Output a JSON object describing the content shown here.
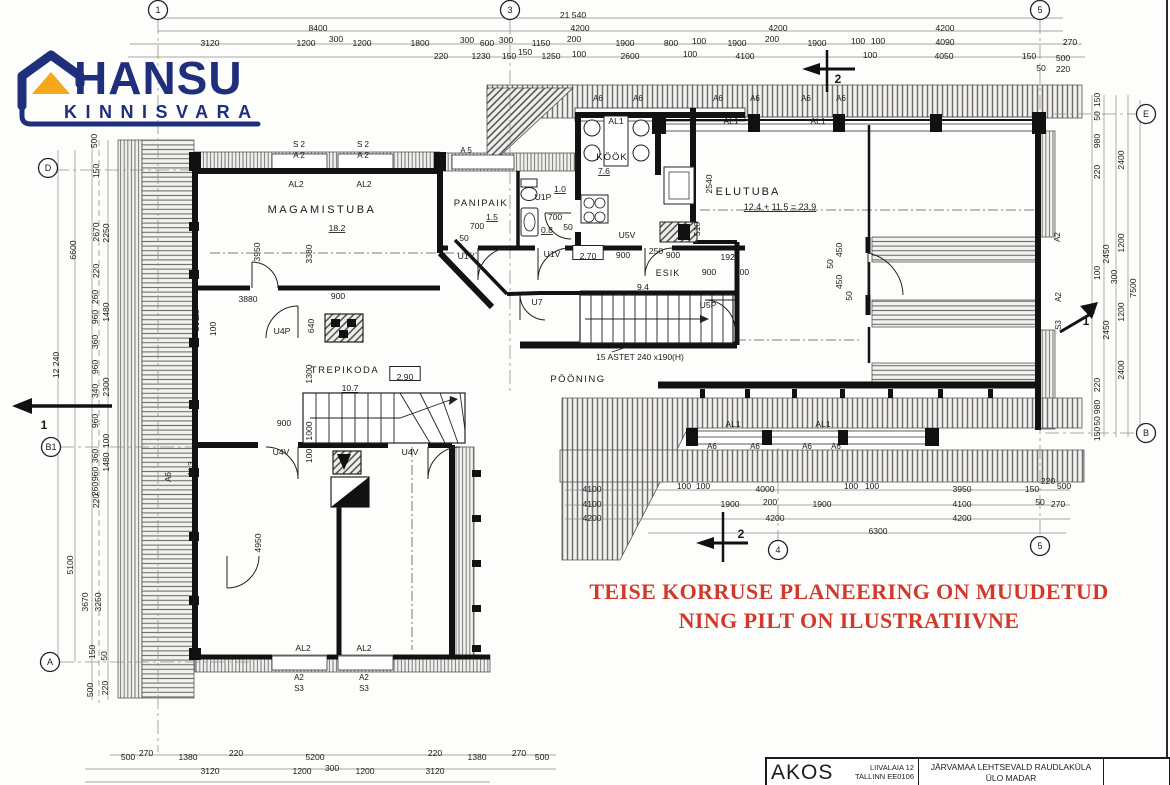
{
  "logo": {
    "name": "HANSU",
    "subname": "KINNISVARA",
    "brand_color": "#1f2f7c",
    "roof_color": "#f5a81c"
  },
  "disclaimer": {
    "line1": "TEISE KORRUSE PLANEERING ON  MUUDETUD",
    "line2": "NING PILT ON ILUSTRATIIVNE",
    "color": "#d0392b"
  },
  "title_block": {
    "company": "AKOS",
    "address_line1": "LIIVALAIA 12",
    "address_line2": "TALLINN EE0106",
    "project_line1": "JÄRVAMAA LEHTSEVALD RAUDLAKÜLA",
    "project_line2": "ÜLO MADAR"
  },
  "plan": {
    "overall_width_mm": "21 540",
    "overall_height_mm": "12 240",
    "bubbles": [
      {
        "t": "1",
        "x": 158,
        "y": 10
      },
      {
        "t": "3",
        "x": 510,
        "y": 10
      },
      {
        "t": "5",
        "x": 1040,
        "y": 10
      },
      {
        "t": "D",
        "x": 48,
        "y": 168
      },
      {
        "t": "B1",
        "x": 51,
        "y": 447
      },
      {
        "t": "A",
        "x": 50,
        "y": 662
      },
      {
        "t": "E",
        "x": 1146,
        "y": 114
      },
      {
        "t": "B",
        "x": 1146,
        "y": 433
      },
      {
        "t": "4",
        "x": 778,
        "y": 550
      },
      {
        "t": "5",
        "x": 1040,
        "y": 546
      }
    ],
    "labels": [
      {
        "t": "21 540",
        "x": 573,
        "y": 15
      },
      {
        "t": "8400",
        "x": 318,
        "y": 28
      },
      {
        "t": "4200",
        "x": 580,
        "y": 28
      },
      {
        "t": "4200",
        "x": 778,
        "y": 28
      },
      {
        "t": "4200",
        "x": 945,
        "y": 28
      },
      {
        "t": "3120",
        "x": 210,
        "y": 43
      },
      {
        "t": "1200",
        "x": 306,
        "y": 43
      },
      {
        "t": "300",
        "x": 336,
        "y": 39
      },
      {
        "t": "1200",
        "x": 362,
        "y": 43
      },
      {
        "t": "1800",
        "x": 420,
        "y": 43
      },
      {
        "t": "300",
        "x": 467,
        "y": 40
      },
      {
        "t": "600",
        "x": 487,
        "y": 43
      },
      {
        "t": "300",
        "x": 506,
        "y": 40
      },
      {
        "t": "1150",
        "x": 541,
        "y": 43
      },
      {
        "t": "200",
        "x": 574,
        "y": 39
      },
      {
        "t": "1900",
        "x": 625,
        "y": 43
      },
      {
        "t": "800",
        "x": 671,
        "y": 43
      },
      {
        "t": "100",
        "x": 699,
        "y": 41
      },
      {
        "t": "1900",
        "x": 737,
        "y": 43
      },
      {
        "t": "200",
        "x": 772,
        "y": 39
      },
      {
        "t": "1900",
        "x": 817,
        "y": 43
      },
      {
        "t": "100",
        "x": 858,
        "y": 41
      },
      {
        "t": "100",
        "x": 878,
        "y": 41
      },
      {
        "t": "4090",
        "x": 945,
        "y": 42
      },
      {
        "t": "270",
        "x": 1070,
        "y": 42
      },
      {
        "t": "220",
        "x": 441,
        "y": 56
      },
      {
        "t": "1230",
        "x": 481,
        "y": 56
      },
      {
        "t": "150",
        "x": 509,
        "y": 56
      },
      {
        "t": "150",
        "x": 525,
        "y": 52
      },
      {
        "t": "1250",
        "x": 551,
        "y": 56
      },
      {
        "t": "100",
        "x": 579,
        "y": 54
      },
      {
        "t": "2600",
        "x": 630,
        "y": 56
      },
      {
        "t": "100",
        "x": 690,
        "y": 54
      },
      {
        "t": "4100",
        "x": 745,
        "y": 56
      },
      {
        "t": "100",
        "x": 870,
        "y": 55
      },
      {
        "t": "4050",
        "x": 944,
        "y": 56
      },
      {
        "t": "150",
        "x": 1029,
        "y": 56
      },
      {
        "t": "500",
        "x": 1063,
        "y": 58
      },
      {
        "t": "50",
        "x": 1041,
        "y": 68
      },
      {
        "t": "220",
        "x": 1063,
        "y": 69
      },
      {
        "t": "500",
        "x": 94,
        "y": 141,
        "r": 1
      },
      {
        "t": "150",
        "x": 96,
        "y": 171,
        "r": 1
      },
      {
        "t": "2670",
        "x": 96,
        "y": 232,
        "r": 1
      },
      {
        "t": "2250",
        "x": 106,
        "y": 233,
        "r": 1
      },
      {
        "t": "6600",
        "x": 73,
        "y": 250,
        "r": 1
      },
      {
        "t": "220",
        "x": 96,
        "y": 271,
        "r": 1
      },
      {
        "t": "260",
        "x": 95,
        "y": 297,
        "r": 1
      },
      {
        "t": "960",
        "x": 95,
        "y": 317,
        "r": 1
      },
      {
        "t": "1480",
        "x": 106,
        "y": 312,
        "r": 1
      },
      {
        "t": "360",
        "x": 95,
        "y": 342,
        "r": 1
      },
      {
        "t": "12 240",
        "x": 56,
        "y": 365,
        "r": 1
      },
      {
        "t": "960",
        "x": 95,
        "y": 367,
        "r": 1
      },
      {
        "t": "340",
        "x": 95,
        "y": 391,
        "r": 1
      },
      {
        "t": "2300",
        "x": 106,
        "y": 387,
        "r": 1
      },
      {
        "t": "960",
        "x": 95,
        "y": 421,
        "r": 1
      },
      {
        "t": "100",
        "x": 106,
        "y": 441,
        "r": 1
      },
      {
        "t": "360",
        "x": 95,
        "y": 456,
        "r": 1
      },
      {
        "t": "1480",
        "x": 106,
        "y": 462,
        "r": 1
      },
      {
        "t": "960",
        "x": 95,
        "y": 474,
        "r": 1
      },
      {
        "t": "260",
        "x": 95,
        "y": 489,
        "r": 1
      },
      {
        "t": "220",
        "x": 96,
        "y": 501,
        "r": 1
      },
      {
        "t": "5100",
        "x": 70,
        "y": 565,
        "r": 1
      },
      {
        "t": "3670",
        "x": 85,
        "y": 602,
        "r": 1
      },
      {
        "t": "3250",
        "x": 98,
        "y": 602,
        "r": 1
      },
      {
        "t": "150",
        "x": 92,
        "y": 652,
        "r": 1
      },
      {
        "t": "50",
        "x": 104,
        "y": 656,
        "r": 1
      },
      {
        "t": "500",
        "x": 90,
        "y": 690,
        "r": 1
      },
      {
        "t": "220",
        "x": 105,
        "y": 688,
        "r": 1
      },
      {
        "t": "150",
        "x": 1097,
        "y": 100,
        "r": 1
      },
      {
        "t": "50",
        "x": 1097,
        "y": 116,
        "r": 1
      },
      {
        "t": "980",
        "x": 1097,
        "y": 141,
        "r": 1
      },
      {
        "t": "2400",
        "x": 1121,
        "y": 160,
        "r": 1
      },
      {
        "t": "220",
        "x": 1097,
        "y": 172,
        "r": 1
      },
      {
        "t": "2450",
        "x": 1106,
        "y": 254,
        "r": 1
      },
      {
        "t": "1200",
        "x": 1121,
        "y": 243,
        "r": 1
      },
      {
        "t": "100",
        "x": 1097,
        "y": 273,
        "r": 1
      },
      {
        "t": "300",
        "x": 1114,
        "y": 277,
        "r": 1
      },
      {
        "t": "7500",
        "x": 1133,
        "y": 288,
        "r": 1
      },
      {
        "t": "1200",
        "x": 1121,
        "y": 312,
        "r": 1
      },
      {
        "t": "2450",
        "x": 1106,
        "y": 330,
        "r": 1
      },
      {
        "t": "2400",
        "x": 1121,
        "y": 370,
        "r": 1
      },
      {
        "t": "220",
        "x": 1097,
        "y": 385,
        "r": 1
      },
      {
        "t": "980",
        "x": 1097,
        "y": 407,
        "r": 1
      },
      {
        "t": "50",
        "x": 1097,
        "y": 421,
        "r": 1
      },
      {
        "t": "150",
        "x": 1097,
        "y": 434,
        "r": 1
      },
      {
        "t": "500",
        "x": 128,
        "y": 757
      },
      {
        "t": "270",
        "x": 146,
        "y": 753
      },
      {
        "t": "1380",
        "x": 188,
        "y": 757
      },
      {
        "t": "220",
        "x": 236,
        "y": 753
      },
      {
        "t": "5200",
        "x": 315,
        "y": 757
      },
      {
        "t": "220",
        "x": 435,
        "y": 753
      },
      {
        "t": "1380",
        "x": 477,
        "y": 757
      },
      {
        "t": "270",
        "x": 519,
        "y": 753
      },
      {
        "t": "500",
        "x": 542,
        "y": 757
      },
      {
        "t": "3120",
        "x": 210,
        "y": 771
      },
      {
        "t": "1200",
        "x": 302,
        "y": 771
      },
      {
        "t": "300",
        "x": 332,
        "y": 768
      },
      {
        "t": "1200",
        "x": 365,
        "y": 771
      },
      {
        "t": "3120",
        "x": 435,
        "y": 771
      },
      {
        "t": "4100",
        "x": 592,
        "y": 489
      },
      {
        "t": "100",
        "x": 684,
        "y": 486
      },
      {
        "t": "100",
        "x": 703,
        "y": 486
      },
      {
        "t": "4000",
        "x": 765,
        "y": 489
      },
      {
        "t": "100",
        "x": 851,
        "y": 486
      },
      {
        "t": "100",
        "x": 872,
        "y": 486
      },
      {
        "t": "3950",
        "x": 962,
        "y": 489
      },
      {
        "t": "150",
        "x": 1032,
        "y": 489
      },
      {
        "t": "220",
        "x": 1048,
        "y": 481
      },
      {
        "t": "500",
        "x": 1064,
        "y": 486
      },
      {
        "t": "4100",
        "x": 592,
        "y": 504
      },
      {
        "t": "1900",
        "x": 730,
        "y": 504
      },
      {
        "t": "200",
        "x": 770,
        "y": 502
      },
      {
        "t": "1900",
        "x": 822,
        "y": 504
      },
      {
        "t": "4100",
        "x": 962,
        "y": 504
      },
      {
        "t": "50",
        "x": 1040,
        "y": 502
      },
      {
        "t": "270",
        "x": 1058,
        "y": 504
      },
      {
        "t": "4200",
        "x": 592,
        "y": 518
      },
      {
        "t": "4200",
        "x": 775,
        "y": 518
      },
      {
        "t": "4200",
        "x": 962,
        "y": 518
      },
      {
        "t": "6300",
        "x": 878,
        "y": 531
      },
      {
        "t": "MAGAMISTUBA",
        "x": 322,
        "y": 210,
        "s": 11,
        "sp": 2.5,
        "n": "room-label-magamistuba"
      },
      {
        "t": "18.2",
        "x": 337,
        "y": 228,
        "u": 1,
        "n": "room-area"
      },
      {
        "t": "PANIPAIK",
        "x": 481,
        "y": 203,
        "s": 9.5,
        "sp": 1.5,
        "n": "room-label-panipaik"
      },
      {
        "t": "1.5",
        "x": 492,
        "y": 217,
        "u": 1,
        "n": "room-area"
      },
      {
        "t": "KÖÖK",
        "x": 612,
        "y": 157,
        "s": 9.5,
        "sp": 1,
        "n": "room-label-kook"
      },
      {
        "t": "7.6",
        "x": 604,
        "y": 171,
        "u": 1,
        "n": "room-area"
      },
      {
        "t": "ELUTUBA",
        "x": 748,
        "y": 192,
        "s": 11,
        "sp": 2,
        "n": "room-label-elutuba"
      },
      {
        "t": "12.4 + 11.5 = 23.9",
        "x": 780,
        "y": 207,
        "u": 1,
        "s": 9,
        "n": "room-area"
      },
      {
        "t": "TREPIKODA",
        "x": 345,
        "y": 370,
        "s": 9.5,
        "sp": 1.5,
        "n": "room-label-trepikoda"
      },
      {
        "t": "10.7",
        "x": 350,
        "y": 388,
        "u": 1,
        "n": "room-area"
      },
      {
        "t": "PÖÖNING",
        "x": 578,
        "y": 379,
        "s": 9.5,
        "sp": 1.5,
        "n": "room-label-pooning"
      },
      {
        "t": "ESIK",
        "x": 668,
        "y": 273,
        "s": 9,
        "sp": 1,
        "n": "room-label-esik"
      },
      {
        "t": "9.4",
        "x": 643,
        "y": 287,
        "u": 1,
        "n": "room-area"
      },
      {
        "t": "U1P",
        "x": 543,
        "y": 197
      },
      {
        "t": "1.0",
        "x": 560,
        "y": 189,
        "u": 1,
        "n": "room-area"
      },
      {
        "t": "0.8",
        "x": 547,
        "y": 230,
        "u": 1,
        "n": "room-area"
      },
      {
        "t": "700",
        "x": 477,
        "y": 226
      },
      {
        "t": "50",
        "x": 464,
        "y": 238
      },
      {
        "t": "700",
        "x": 555,
        "y": 217
      },
      {
        "t": "50",
        "x": 568,
        "y": 227
      },
      {
        "t": "U5V",
        "x": 627,
        "y": 235
      },
      {
        "t": "U1V",
        "x": 466,
        "y": 256
      },
      {
        "t": "U1V",
        "x": 552,
        "y": 254
      },
      {
        "t": "2.70",
        "x": 588,
        "y": 256,
        "box": 1
      },
      {
        "t": "900",
        "x": 623,
        "y": 255
      },
      {
        "t": "250",
        "x": 656,
        "y": 251
      },
      {
        "t": "900",
        "x": 673,
        "y": 255
      },
      {
        "t": "1920",
        "x": 730,
        "y": 257
      },
      {
        "t": "900",
        "x": 709,
        "y": 272
      },
      {
        "t": "100",
        "x": 742,
        "y": 272
      },
      {
        "t": "U7",
        "x": 537,
        "y": 302
      },
      {
        "t": "U5P",
        "x": 708,
        "y": 305
      },
      {
        "t": "15 ASTET 240 x190(H)",
        "x": 640,
        "y": 357,
        "s": 8.5,
        "n": "stairs-note"
      },
      {
        "t": "2.90",
        "x": 405,
        "y": 377,
        "box": 1
      },
      {
        "t": "U4P",
        "x": 282,
        "y": 331
      },
      {
        "t": "U4V",
        "x": 281,
        "y": 452
      },
      {
        "t": "U4V",
        "x": 410,
        "y": 452
      },
      {
        "t": "2540",
        "x": 709,
        "y": 184,
        "r": 1
      },
      {
        "t": "510",
        "x": 697,
        "y": 229,
        "r": 1
      },
      {
        "t": "50",
        "x": 830,
        "y": 264,
        "r": 1
      },
      {
        "t": "450",
        "x": 839,
        "y": 250,
        "r": 1
      },
      {
        "t": "450",
        "x": 839,
        "y": 282,
        "r": 1
      },
      {
        "t": "50",
        "x": 849,
        "y": 296,
        "r": 1
      },
      {
        "t": "3950",
        "x": 257,
        "y": 252,
        "r": 1
      },
      {
        "t": "3380",
        "x": 309,
        "y": 254,
        "r": 1
      },
      {
        "t": "3880",
        "x": 248,
        "y": 299
      },
      {
        "t": "900",
        "x": 338,
        "y": 296
      },
      {
        "t": "640",
        "x": 311,
        "y": 326,
        "r": 1
      },
      {
        "t": "260",
        "x": 196,
        "y": 324,
        "r": 1
      },
      {
        "t": "100",
        "x": 213,
        "y": 329,
        "r": 1
      },
      {
        "t": "1300",
        "x": 309,
        "y": 374,
        "r": 1
      },
      {
        "t": "900",
        "x": 284,
        "y": 423
      },
      {
        "t": "1000",
        "x": 309,
        "y": 431,
        "r": 1
      },
      {
        "t": "100",
        "x": 309,
        "y": 456,
        "r": 1
      },
      {
        "t": "4950",
        "x": 258,
        "y": 543,
        "r": 1
      },
      {
        "t": "S 2",
        "x": 299,
        "y": 144,
        "s": 8
      },
      {
        "t": "A 2",
        "x": 299,
        "y": 155,
        "s": 8
      },
      {
        "t": "S 2",
        "x": 363,
        "y": 144,
        "s": 8
      },
      {
        "t": "A 2",
        "x": 363,
        "y": 155,
        "s": 8
      },
      {
        "t": "A 5",
        "x": 466,
        "y": 150,
        "s": 8
      },
      {
        "t": "AL2",
        "x": 296,
        "y": 184
      },
      {
        "t": "AL2",
        "x": 364,
        "y": 184
      },
      {
        "t": "A6",
        "x": 598,
        "y": 98,
        "s": 8
      },
      {
        "t": "A6",
        "x": 638,
        "y": 98,
        "s": 8
      },
      {
        "t": "A6",
        "x": 718,
        "y": 98,
        "s": 8
      },
      {
        "t": "A6",
        "x": 755,
        "y": 98,
        "s": 8
      },
      {
        "t": "A6",
        "x": 806,
        "y": 98,
        "s": 8
      },
      {
        "t": "A6",
        "x": 841,
        "y": 98,
        "s": 8
      },
      {
        "t": "AL1",
        "x": 616,
        "y": 121
      },
      {
        "t": "AL1",
        "x": 731,
        "y": 121
      },
      {
        "t": "AL1",
        "x": 818,
        "y": 121
      },
      {
        "t": "AL1",
        "x": 733,
        "y": 424
      },
      {
        "t": "AL1",
        "x": 823,
        "y": 424
      },
      {
        "t": "A6",
        "x": 712,
        "y": 446,
        "s": 8
      },
      {
        "t": "A6",
        "x": 755,
        "y": 446,
        "s": 8
      },
      {
        "t": "A6",
        "x": 807,
        "y": 446,
        "s": 8
      },
      {
        "t": "A6",
        "x": 836,
        "y": 446,
        "s": 8
      },
      {
        "t": "AL2",
        "x": 303,
        "y": 648
      },
      {
        "t": "AL2",
        "x": 364,
        "y": 648
      },
      {
        "t": "A2",
        "x": 299,
        "y": 677,
        "s": 8
      },
      {
        "t": "S3",
        "x": 299,
        "y": 688,
        "s": 8
      },
      {
        "t": "A2",
        "x": 364,
        "y": 677,
        "s": 8
      },
      {
        "t": "S3",
        "x": 364,
        "y": 688,
        "s": 8
      },
      {
        "t": "AL3",
        "x": 196,
        "y": 317,
        "r": 1
      },
      {
        "t": "AL3",
        "x": 191,
        "y": 469,
        "r": 1
      },
      {
        "t": "A6",
        "x": 168,
        "y": 477,
        "r": 1,
        "s": 8
      },
      {
        "t": "A2",
        "x": 1057,
        "y": 237,
        "r": 1,
        "s": 8
      },
      {
        "t": "A2",
        "x": 1058,
        "y": 297,
        "r": 1,
        "s": 8
      },
      {
        "t": "S3",
        "x": 1058,
        "y": 325,
        "r": 1,
        "s": 8
      },
      {
        "t": "2",
        "x": 838,
        "y": 80,
        "s": 12,
        "b": 1,
        "n": "section-mark"
      },
      {
        "t": "2",
        "x": 741,
        "y": 535,
        "s": 12,
        "b": 1,
        "n": "section-mark"
      },
      {
        "t": "1",
        "x": 44,
        "y": 426,
        "s": 12,
        "b": 1,
        "n": "section-mark"
      },
      {
        "t": "1",
        "x": 1086,
        "y": 322,
        "s": 12,
        "b": 1,
        "n": "section-mark"
      }
    ]
  }
}
